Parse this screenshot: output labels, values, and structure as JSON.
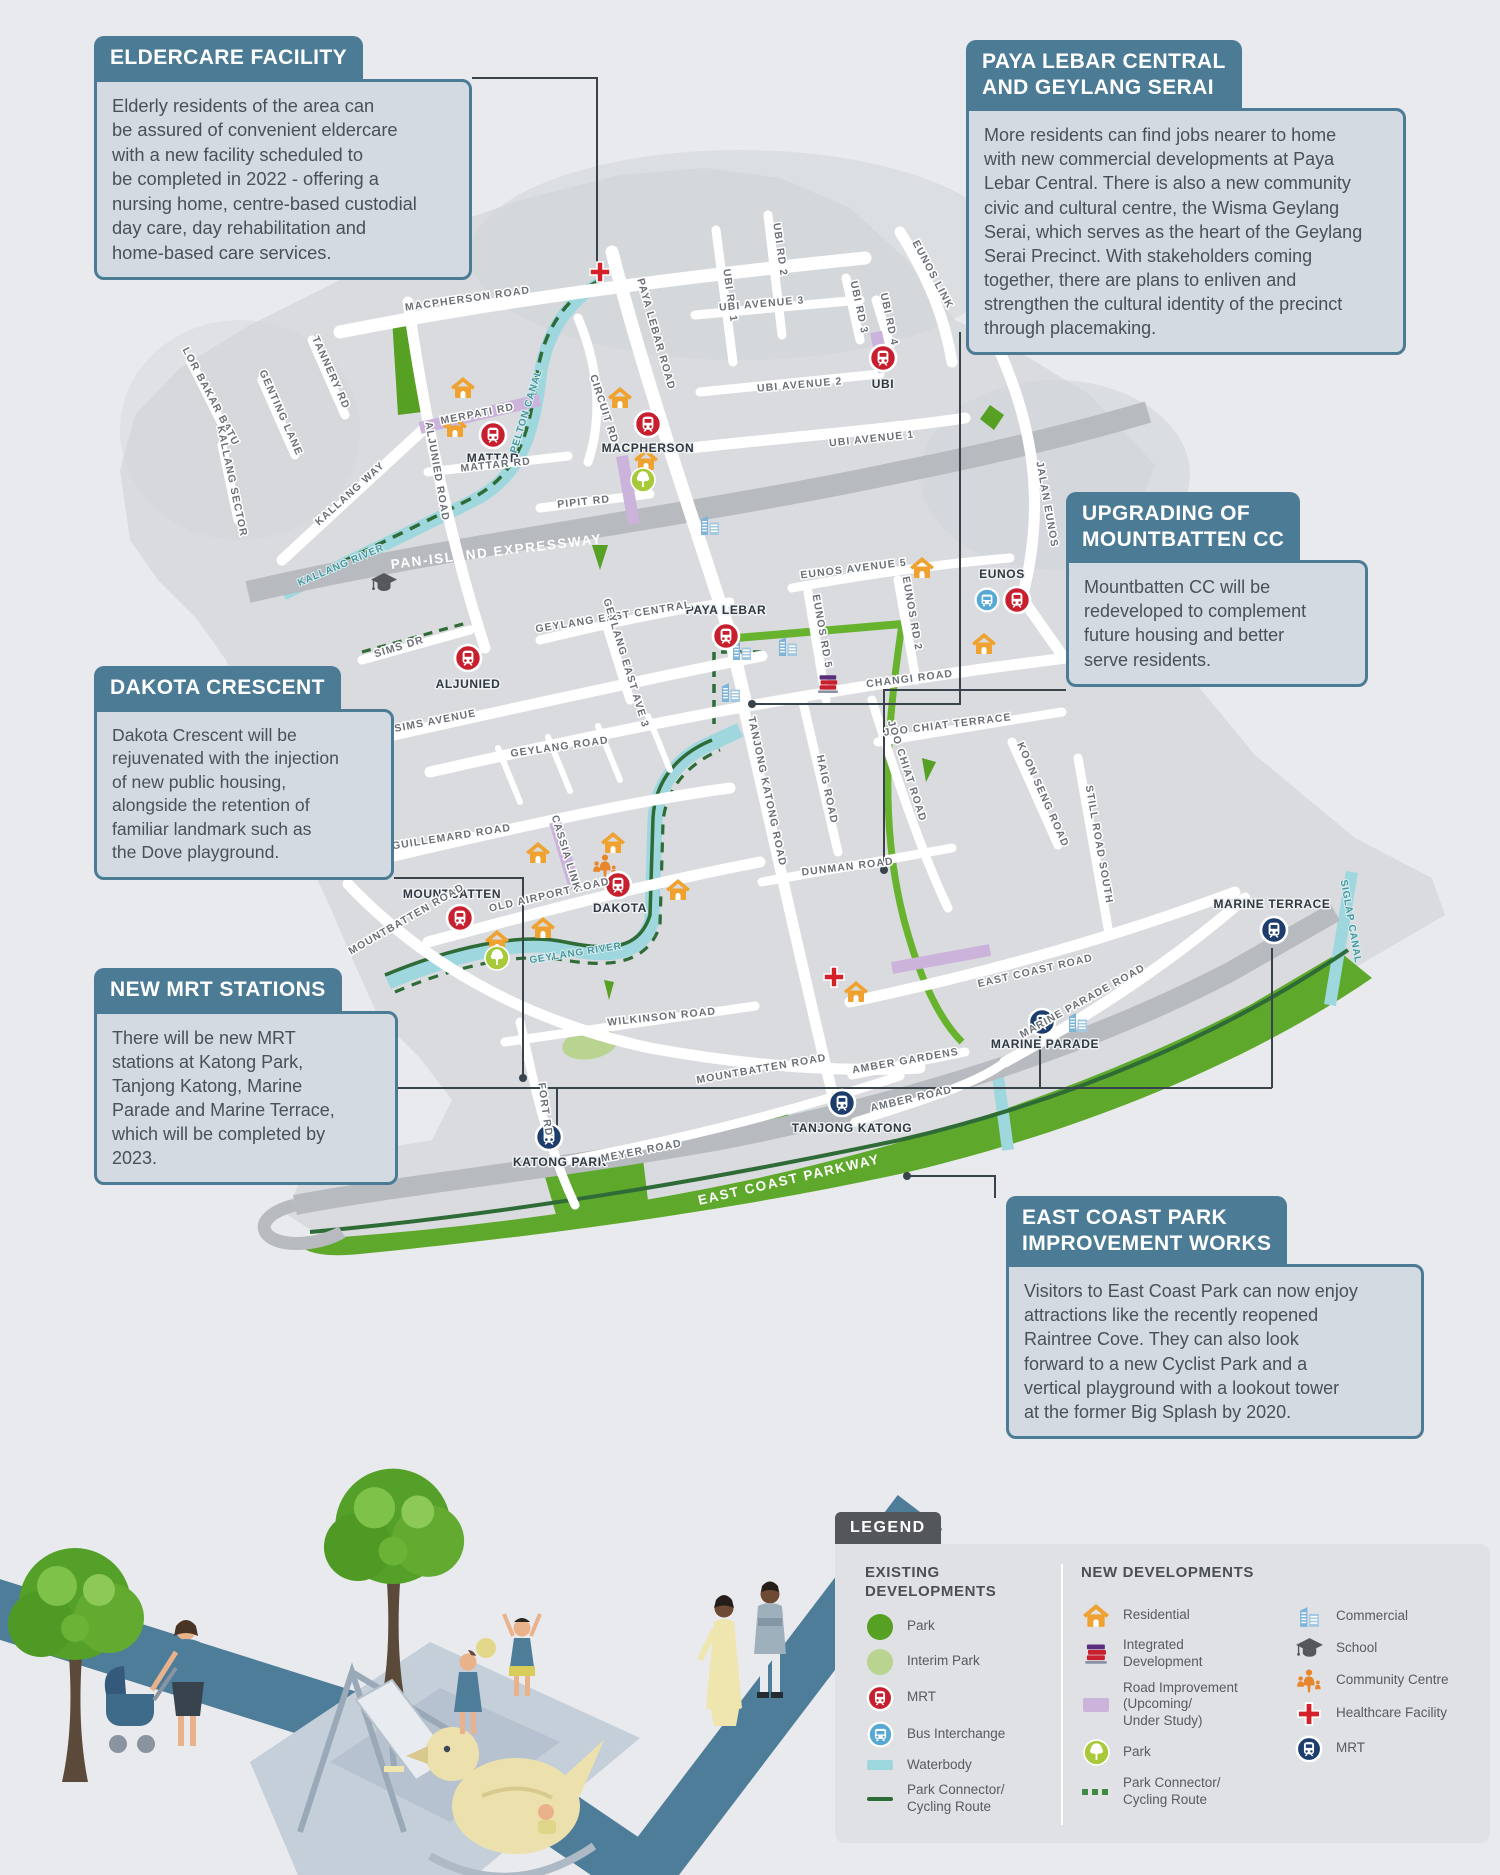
{
  "title": "Kallang / Geylang / Marine Parade development infographic map",
  "colors": {
    "callout_header": "#4b7b95",
    "callout_body_bg": "#d3dae2",
    "land": "#d9dbde",
    "road": "#ffffff",
    "expressway": "#b7babe",
    "waterbody": "#9ed7dd",
    "park_existing": "#56a024",
    "park_coastal": "#5ea82b",
    "interim_park": "#b9d490",
    "park_connector": "#2e6b36",
    "cycling_route": "#67b32e",
    "road_improvement": "#cbb3dc",
    "mrt_existing": "#c71f2d",
    "mrt_new": "#1d3e6d",
    "bus_interchange": "#57a9d5",
    "residential": "#efa22f",
    "healthcare": "#d42028",
    "legend_tab": "#53575b"
  },
  "callouts": [
    {
      "id": "eldercare",
      "title": "ELDERCARE FACILITY",
      "body": "Elderly residents of the area can\nbe assured of convenient eldercare\nwith a new facility scheduled to\nbe completed in 2022 - offering a\nnursing home, centre-based custodial\nday care, day rehabilitation and\nhome-based care services."
    },
    {
      "id": "paya-lebar",
      "title": "PAYA LEBAR CENTRAL\nAND GEYLANG SERAI",
      "body": "More residents can find jobs nearer to home\nwith new commercial developments at Paya\nLebar Central. There is also a new community\ncivic and cultural centre, the Wisma Geylang\nSerai, which serves as the heart of the Geylang\nSerai Precinct. With stakeholders coming\ntogether, there are plans to enliven and\nstrengthen the cultural identity of the precinct\nthrough placemaking."
    },
    {
      "id": "mountbatten-cc",
      "title": "UPGRADING OF\nMOUNTBATTEN CC",
      "body": "Mountbatten CC will be\nredeveloped to complement\nfuture housing and better\nserve residents."
    },
    {
      "id": "dakota",
      "title": "DAKOTA CRESCENT",
      "body": "Dakota Crescent will be\nrejuvenated with the injection\nof new public housing,\nalongside the retention of\nfamiliar landmark such as\nthe Dove playground."
    },
    {
      "id": "new-mrt",
      "title": "NEW MRT STATIONS",
      "body": "There will be new MRT\nstations at Katong Park,\nTanjong Katong, Marine\nParade and Marine Terrace,\nwhich will be completed by\n2023."
    },
    {
      "id": "east-coast",
      "title": "EAST COAST PARK\nIMPROVEMENT WORKS",
      "body": "Visitors to East Coast Park can now enjoy\nattractions like the recently reopened\nRaintree Cove. They can also look\nforward to a new Cyclist Park and a\nvertical playground with a lookout tower\nat the former Big Splash by 2020."
    }
  ],
  "legend": {
    "tab": "LEGEND",
    "existing": {
      "heading": "EXISTING\nDEVELOPMENTS",
      "items": [
        {
          "icon": "park",
          "label": "Park"
        },
        {
          "icon": "interim-park",
          "label": "Interim Park"
        },
        {
          "icon": "mrt",
          "label": "MRT"
        },
        {
          "icon": "bus-interchange",
          "label": "Bus Interchange"
        },
        {
          "icon": "waterbody",
          "label": "Waterbody"
        },
        {
          "icon": "park-connector",
          "label": "Park Connector/\nCycling Route"
        }
      ]
    },
    "new": {
      "heading": "NEW DEVELOPMENTS",
      "col1": [
        {
          "icon": "residential",
          "label": "Residential"
        },
        {
          "icon": "integrated-development",
          "label": "Integrated\nDevelopment"
        },
        {
          "icon": "road-improvement",
          "label": "Road Improvement\n(Upcoming/\nUnder Study)"
        },
        {
          "icon": "park-new",
          "label": "Park"
        },
        {
          "icon": "park-connector-dashed",
          "label": "Park Connector/\nCycling Route"
        }
      ],
      "col2": [
        {
          "icon": "commercial",
          "label": "Commercial"
        },
        {
          "icon": "school",
          "label": "School"
        },
        {
          "icon": "community-centre",
          "label": "Community Centre"
        },
        {
          "icon": "healthcare",
          "label": "Healthcare Facility"
        },
        {
          "icon": "mrt-new",
          "label": "MRT"
        }
      ]
    }
  },
  "map": {
    "labels": {
      "macpherson": "MACPHERSON ROAD",
      "tannery": "TANNERY RD",
      "genting": "GENTING LANE",
      "lor_bakar_batu": "LOR BAKAR BATU",
      "kallang_sector": "KALLANG SECTOR",
      "kallang_way": "KALLANG WAY",
      "merpati": "MERPATI RD",
      "aljunied_road": "ALJUNIED ROAD",
      "mattar_rd": "MATTAR RD",
      "circuit": "CIRCUIT RD",
      "pipit": "PIPIT RD",
      "paya_lebar_road": "PAYA LEBAR ROAD",
      "ubi_rd_1": "UBI RD 1",
      "ubi_rd_2": "UBI RD 2",
      "ubi_rd_3": "UBI RD 3",
      "ubi_rd_4": "UBI RD 4",
      "ubi_ave_1": "UBI AVENUE 1",
      "ubi_ave_2": "UBI AVENUE 2",
      "ubi_ave_3": "UBI AVENUE 3",
      "eunos_link": "EUNOS LINK",
      "jalan_eunos": "JALAN EUNOS",
      "pie": "PAN-ISLAND EXPRESSWAY",
      "sims_dr": "SIMS DR",
      "sims_ave": "SIMS AVENUE",
      "geylang_east_central": "GEYLANG EAST CENTRAL",
      "geylang_east_ave3": "GEYLANG EAST AVE 3",
      "geylang_road": "GEYLANG ROAD",
      "eunos_ave_5": "EUNOS AVENUE 5",
      "eunos_rd_5": "EUNOS RD 5",
      "eunos_rd_2": "EUNOS RD 2",
      "changi": "CHANGI ROAD",
      "joo_chiat_terrace": "JOO CHIAT TERRACE",
      "joo_chiat_road": "JOO CHIAT ROAD",
      "koon_seng": "KOON SENG ROAD",
      "still_road": "STILL ROAD SOUTH",
      "dunman": "DUNMAN ROAD",
      "haig": "HAIG ROAD",
      "tanjong_katong_road": "TANJONG KATONG ROAD",
      "guillemard": "GUILLEMARD ROAD",
      "old_airport": "OLD AIRPORT ROAD",
      "cassia": "CASSIA LINK",
      "mountbatten_road": "MOUNTBATTEN ROAD",
      "wilkinson": "WILKINSON ROAD",
      "east_coast_road": "EAST COAST ROAD",
      "marine_parade_road": "MARINE PARADE ROAD",
      "amber_gardens": "AMBER GARDENS",
      "amber_road": "AMBER ROAD",
      "meyer": "MEYER ROAD",
      "fort": "FORT RD",
      "ecp": "EAST COAST PARKWAY",
      "pelton": "PELTON CANAL",
      "kallang_river": "KALLANG RIVER",
      "geylang_river": "GEYLANG RIVER",
      "siglap": "SIGLAP CANAL"
    },
    "stations": {
      "mattar": "MATTAR",
      "macpherson": "MACPHERSON",
      "ubi": "UBI",
      "aljunied": "ALJUNIED",
      "paya_lebar": "PAYA LEBAR",
      "eunos": "EUNOS",
      "mountbatten": "MOUNTBATTEN",
      "dakota": "DAKOTA",
      "katong_park": "KATONG PARK",
      "tanjong_katong": "TANJONG KATONG",
      "marine_parade": "MARINE PARADE",
      "marine_terrace": "MARINE TERRACE"
    }
  }
}
